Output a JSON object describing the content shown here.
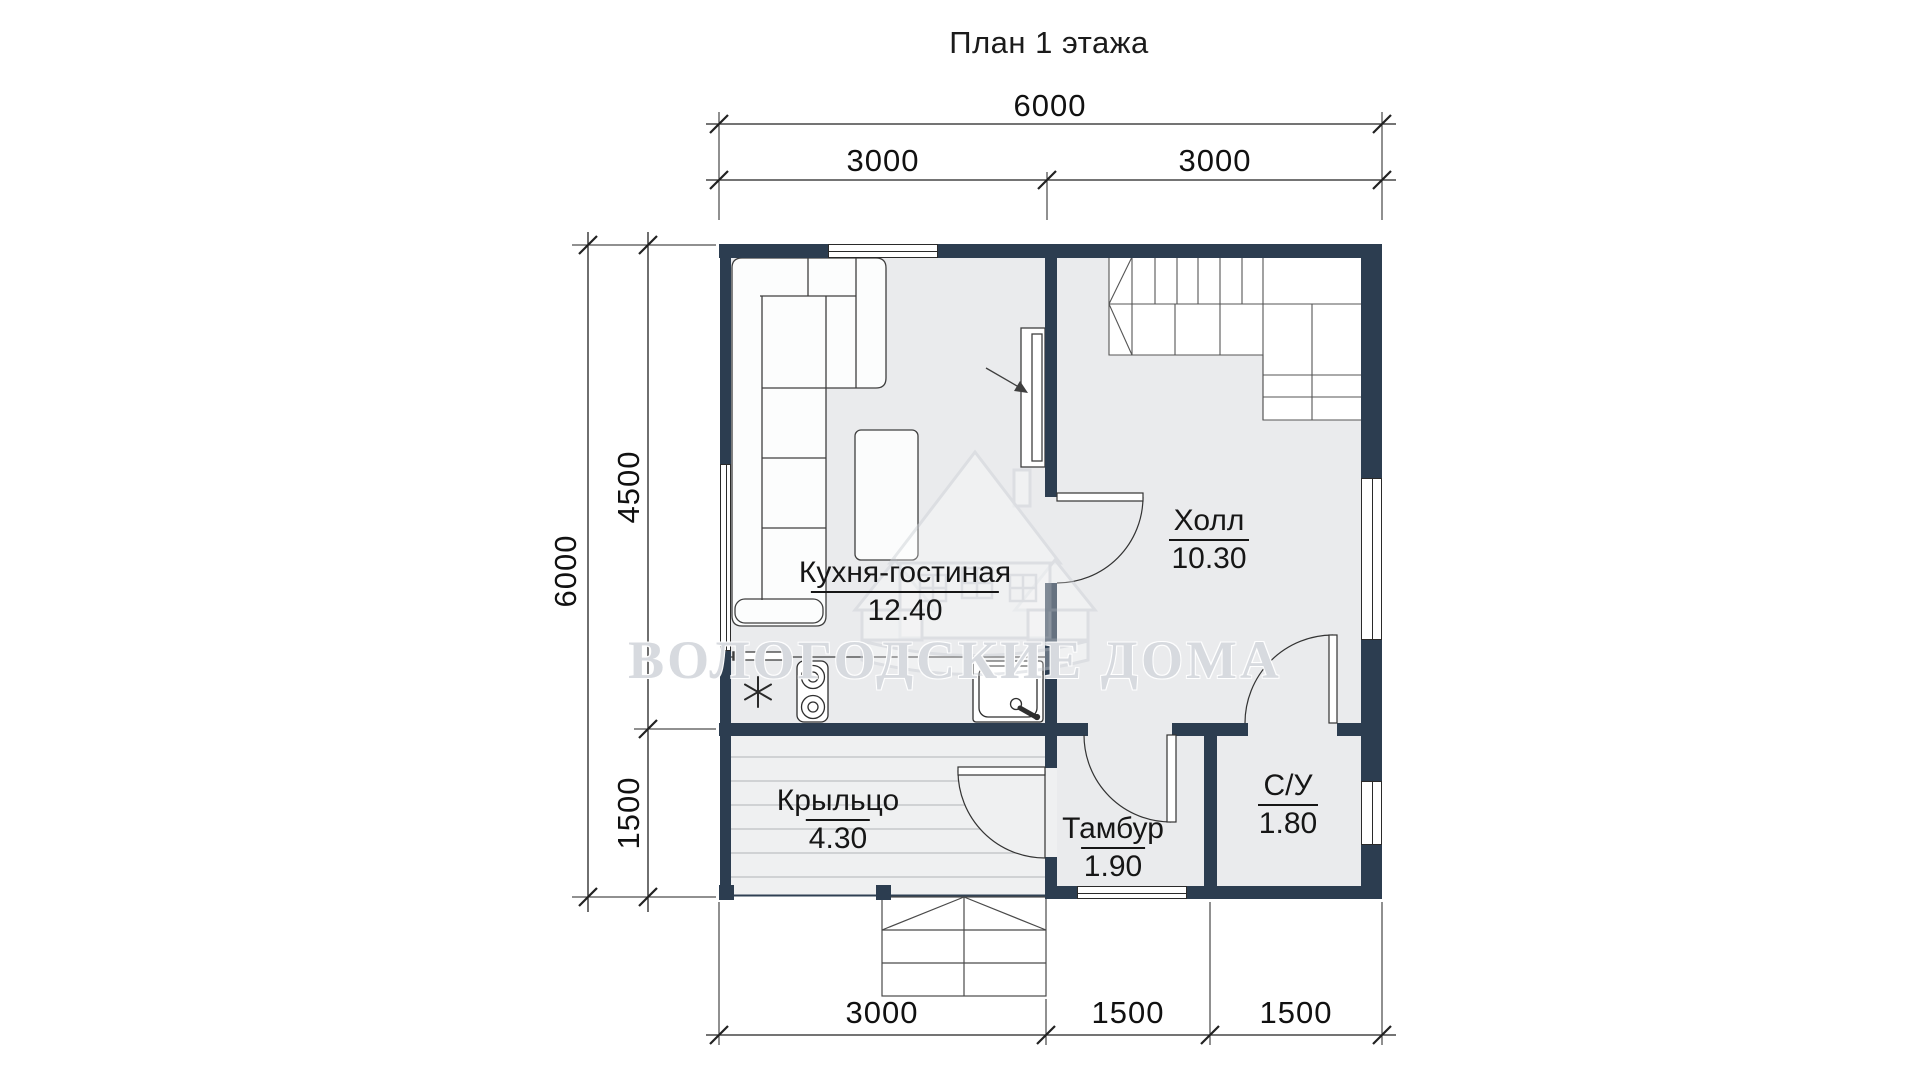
{
  "title": "План 1 этажа",
  "watermark": {
    "text": "ВОЛОГОДСКИЕ ДОМА",
    "logo": "house-logo"
  },
  "dimensions": {
    "top": {
      "total": "6000",
      "segments": [
        "3000",
        "3000"
      ]
    },
    "left": {
      "total": "6000",
      "segments": [
        "4500",
        "1500"
      ]
    },
    "bottom": {
      "segments": [
        "3000",
        "1500",
        "1500"
      ]
    }
  },
  "rooms": [
    {
      "name": "Кухня-гостиная",
      "area": "12.40"
    },
    {
      "name": "Холл",
      "area": "10.30"
    },
    {
      "name": "Крыльцо",
      "area": "4.30"
    },
    {
      "name": "Тамбур",
      "area": "1.90"
    },
    {
      "name": "С/У",
      "area": "1.80"
    }
  ],
  "symbols": [
    "corner-sofa",
    "dining-table",
    "tv-unit",
    "kitchen-counter",
    "stove",
    "sink",
    "stairs",
    "entry-steps",
    "snowflake-symbol"
  ],
  "colors": {
    "wall": "#2c3d50",
    "floor": "#eaebed",
    "porch_floor": "#eff0f1",
    "line": "#333333"
  }
}
